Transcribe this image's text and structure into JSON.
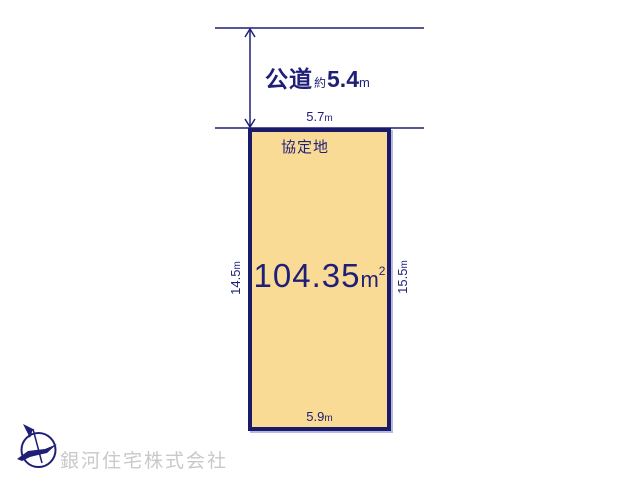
{
  "title": "land-plot-diagram",
  "colors": {
    "ink": "#1f1f78",
    "plot_border": "#1a1a6b",
    "plot_fill": "#f9db95",
    "watermark_gray": "#c9c9c9"
  },
  "road": {
    "label": "公道",
    "approx": "約",
    "width_value": "5.4",
    "unit": "m"
  },
  "plot": {
    "area": {
      "value": "104.35",
      "unit": "m",
      "exponent": "2"
    },
    "top_edge": {
      "value": "5.7",
      "unit": "m"
    },
    "bottom_edge": {
      "value": "5.9",
      "unit": "m"
    },
    "left_edge": {
      "value": "14.5",
      "unit": "m"
    },
    "right_edge": {
      "value": "15.5",
      "unit": "m"
    },
    "corner_note": "協定地"
  },
  "compass": {
    "meaning": "north-compass"
  },
  "watermark": {
    "company_name": "銀河住宅株式会社"
  }
}
